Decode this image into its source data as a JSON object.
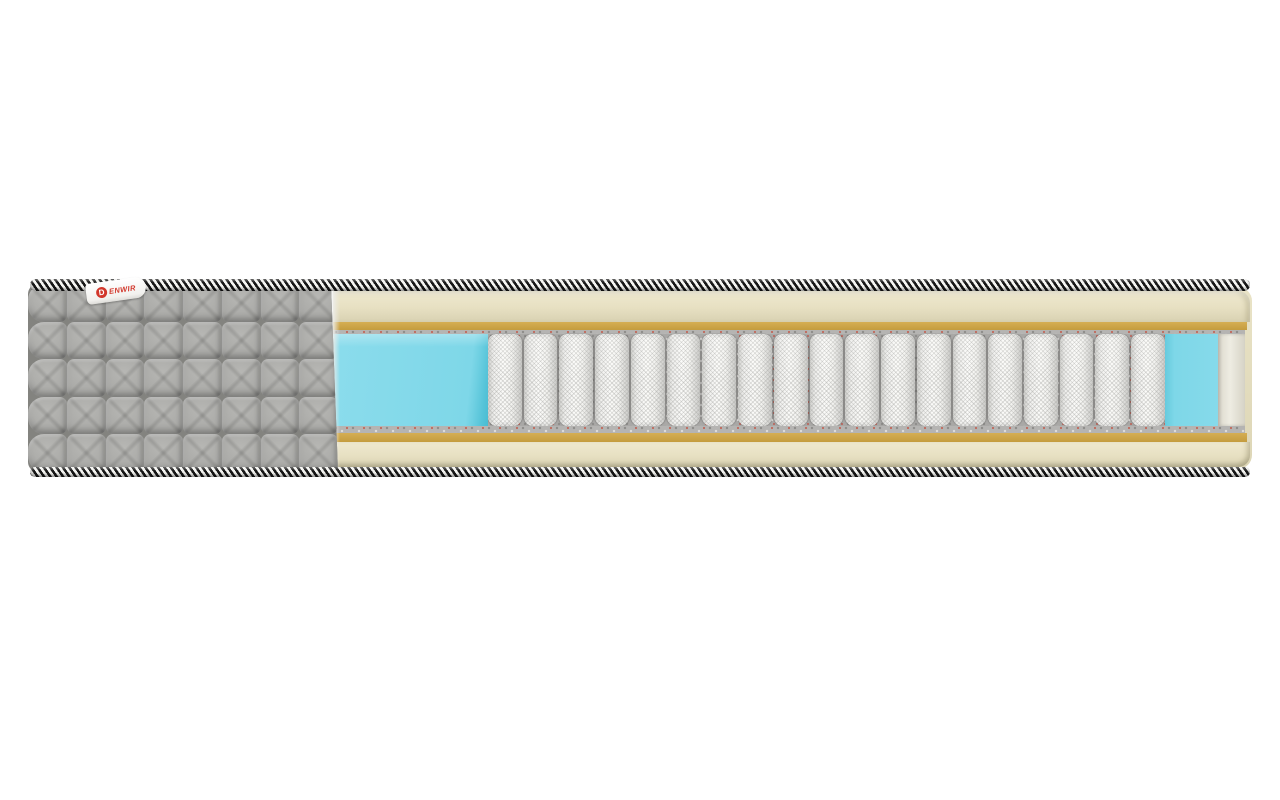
{
  "image": {
    "type": "product-render",
    "subject": "Mattress cross-section showing inner layers"
  },
  "brand_tag": {
    "logo_letter": "D",
    "label": "ENWIR",
    "text_color": "#d2372b",
    "background": "#ffffff"
  },
  "mattress": {
    "spring_count": 19,
    "quilt": {
      "rows": 5,
      "columns": 8
    },
    "layers_top_to_bottom": [
      "braided edge piping (black/white rope)",
      "cream comfort foam layer",
      "gold firm foam strip",
      "speckled felt pad",
      "pocket spring block with blue foam side boxes",
      "speckled felt pad",
      "gold firm foam strip",
      "cream comfort foam layer",
      "braided edge piping (black/white rope)"
    ],
    "colors": {
      "cover_gray": "#a4a4a1",
      "foam_cream": "#e9e3c6",
      "foam_gold": "#c9a245",
      "felt_gray": "#b5b4b2",
      "foam_blue": "#7ed7e8",
      "spring_white": "#f5f5f3",
      "trim_dark": "#161616",
      "trim_light": "#f6f6f3",
      "tag_red": "#d2372b",
      "background": "#ffffff"
    }
  }
}
